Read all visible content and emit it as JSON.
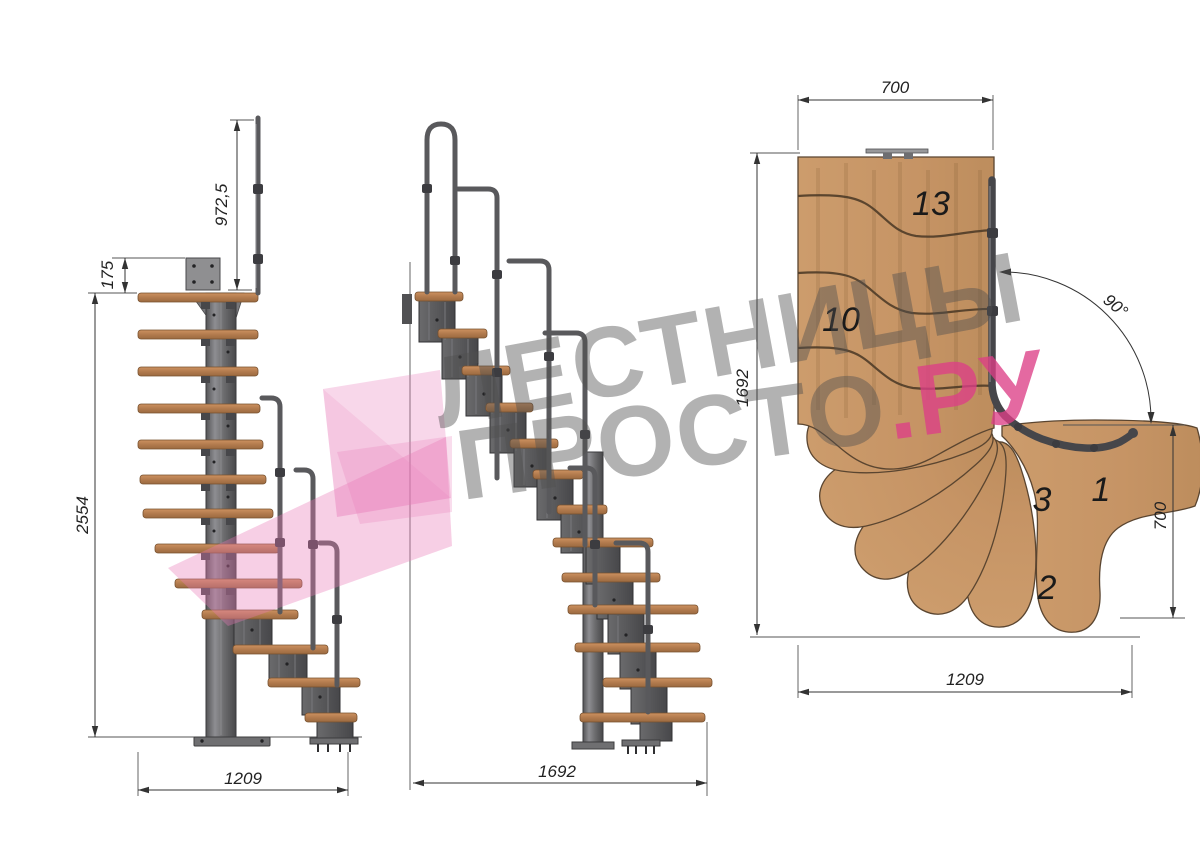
{
  "watermark": {
    "line1": "ЛЕСТНИЦЫ",
    "line2": "ПРОСТО",
    "line2_suffix": ".РУ"
  },
  "side_view": {
    "rail_height": "972,5",
    "plate_offset": "175",
    "total_height": "2554",
    "base_width": "1209"
  },
  "front_view": {
    "base_length": "1692"
  },
  "plan_view": {
    "top_width": "700",
    "side_length": "1692",
    "bottom_width": "1209",
    "right_depth": "700",
    "turn_angle": "90°",
    "step_13": "13",
    "step_10": "10",
    "step_3": "3",
    "step_1": "1",
    "step_2": "2"
  },
  "colors": {
    "background": "#ffffff",
    "wood": "#c89a6a",
    "tread_side": "#b0794c",
    "metal": "#6b6b6d",
    "metal_dark": "#46464a",
    "dimension": "#333333",
    "watermark_gray": "#9b9b9b",
    "watermark_pink": "#dc3f86",
    "logo_pink": "#e87ab8"
  }
}
